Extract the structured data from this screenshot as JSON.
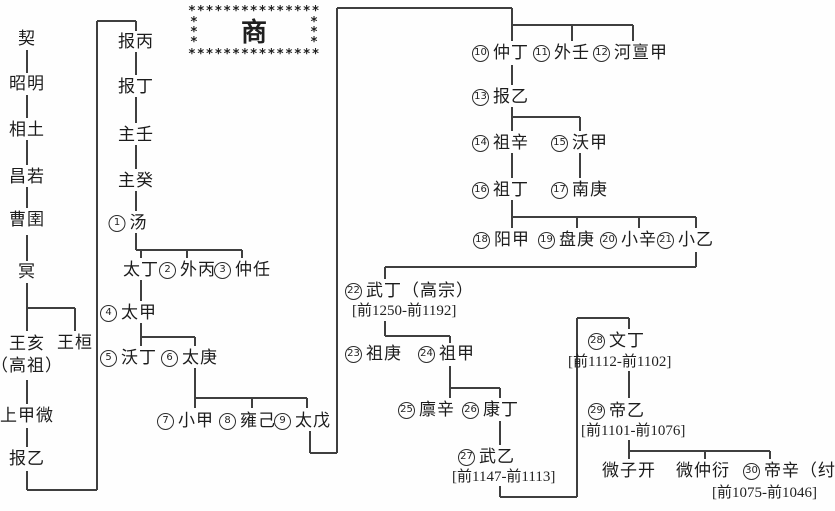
{
  "title": {
    "text": "商",
    "frame_row": "***************",
    "frame_side": "*\n*\n*"
  },
  "colors": {
    "line": "#3f3f3f",
    "text": "#1c1c1c",
    "background": "#fefefe"
  },
  "lineage": {
    "qi": "契",
    "zhaoming": "昭明",
    "xiangtu": "相土",
    "changruo": "昌若",
    "caoyu": "曹圉",
    "ming": "冥",
    "wanghai": "王亥",
    "wanghai_honorific": "（高祖）",
    "wanghuan": "王桓",
    "shangjiawei": "上甲微",
    "baoyi": "报乙",
    "baobing": "报丙",
    "baoding": "报丁",
    "zhuren": "主壬",
    "zhugui": "主癸",
    "taiding": "太丁",
    "weizikai": "微子开",
    "weizhongyan": "微仲衍"
  },
  "kings": [
    {
      "num": "1",
      "name": "汤"
    },
    {
      "num": "2",
      "name": "外丙"
    },
    {
      "num": "3",
      "name": "仲任"
    },
    {
      "num": "4",
      "name": "太甲"
    },
    {
      "num": "5",
      "name": "沃丁"
    },
    {
      "num": "6",
      "name": "太庚"
    },
    {
      "num": "7",
      "name": "小甲"
    },
    {
      "num": "8",
      "name": "雍己"
    },
    {
      "num": "9",
      "name": "太戊"
    },
    {
      "num": "10",
      "name": "仲丁"
    },
    {
      "num": "11",
      "name": "外壬"
    },
    {
      "num": "12",
      "name": "河亶甲"
    },
    {
      "num": "13",
      "name": "报乙"
    },
    {
      "num": "14",
      "name": "祖辛"
    },
    {
      "num": "15",
      "name": "沃甲"
    },
    {
      "num": "16",
      "name": "祖丁"
    },
    {
      "num": "17",
      "name": "南庚"
    },
    {
      "num": "18",
      "name": "阳甲"
    },
    {
      "num": "19",
      "name": "盘庚"
    },
    {
      "num": "20",
      "name": "小辛"
    },
    {
      "num": "21",
      "name": "小乙"
    },
    {
      "num": "22",
      "name": "武丁（高宗）",
      "dates": "[前1250-前1192]"
    },
    {
      "num": "23",
      "name": "祖庚"
    },
    {
      "num": "24",
      "name": "祖甲"
    },
    {
      "num": "25",
      "name": "廪辛"
    },
    {
      "num": "26",
      "name": "康丁"
    },
    {
      "num": "27",
      "name": "武乙",
      "dates": "[前1147-前1113]"
    },
    {
      "num": "28",
      "name": "文丁",
      "dates": "[前1112-前1102]"
    },
    {
      "num": "29",
      "name": "帝乙",
      "dates": "[前1101-前1076]"
    },
    {
      "num": "30",
      "name": "帝辛（纣）",
      "dates": "[前1075-前1046]"
    }
  ]
}
